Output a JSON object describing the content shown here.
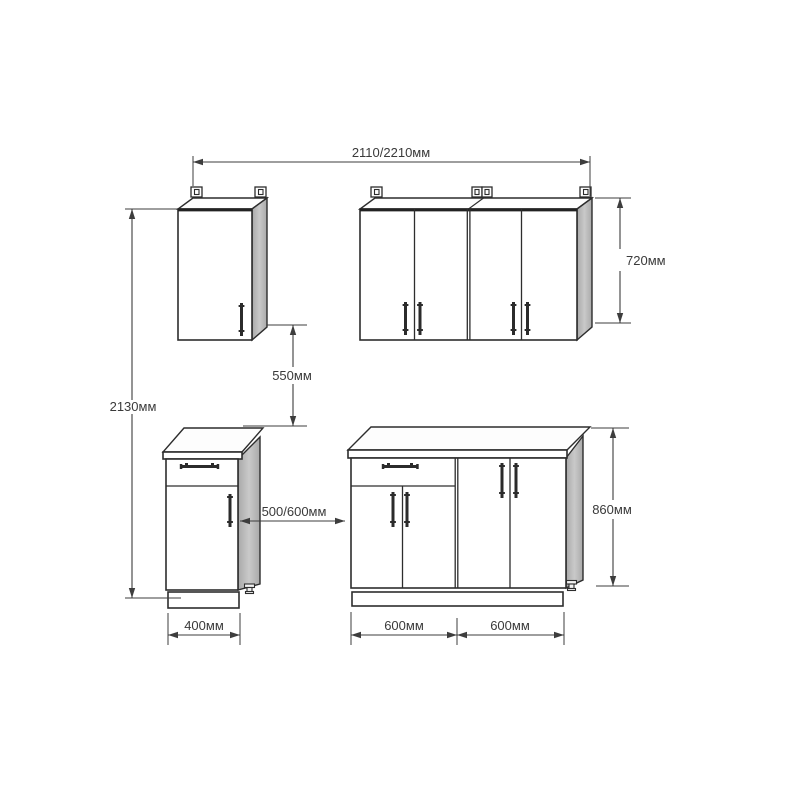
{
  "dims": {
    "total_width": "2110/2210мм",
    "total_height": "2130мм",
    "wall_height": "720мм",
    "gap": "550мм",
    "clearance": "500/600мм",
    "base_height": "860мм",
    "base_small_width": "400мм",
    "base_left_width": "600мм",
    "base_right_width": "600мм"
  },
  "colors": {
    "background": "#ffffff",
    "outline": "#2d2d2d",
    "dimension_line": "#3d3d3d",
    "label_text": "#3a3a3a",
    "side_panel": "#a9a9a9",
    "side_panel_light": "#c9c9c9",
    "handle": "#2b2b2b"
  }
}
